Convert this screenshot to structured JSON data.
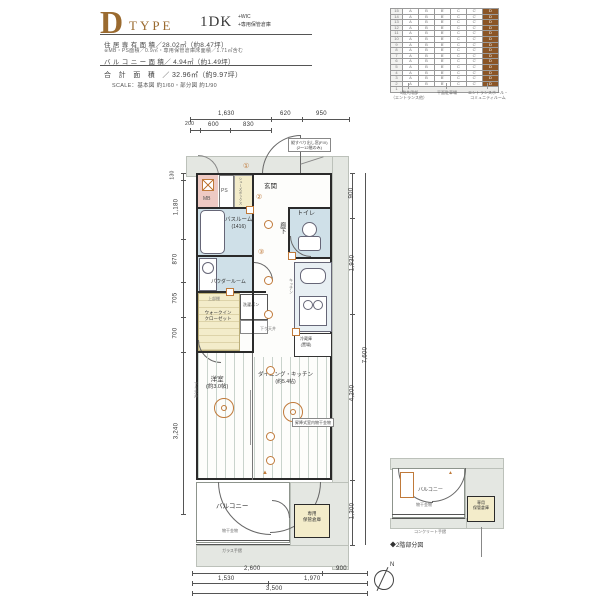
{
  "header": {
    "letter": "D",
    "type_word": "TYPE",
    "plan": "1DK",
    "plan_plus": [
      "+WIC",
      "+専用保管倉庫"
    ],
    "spec1": "住 居 専 有 面 積／28.02㎡（約8.47坪）",
    "spec2": "※MB・PS面積／0.9㎡・専用保管倉庫床面積／1.71㎡含む",
    "spec3": "バ ル コ ニ ー 面 積／ 4.94㎡（約1.49坪）",
    "total": "合　計　面　積　／ 32.96㎡（約9.97坪）",
    "scale": "SCALE：基本図 約1/60・部分図 約1/90"
  },
  "table": {
    "floors": [
      "15",
      "14",
      "13",
      "12",
      "11",
      "10",
      "9",
      "8",
      "7",
      "6",
      "5",
      "4",
      "3",
      "2"
    ],
    "cols": [
      "A",
      "B",
      "B'",
      "C",
      "C'",
      "D"
    ],
    "highlight": "D",
    "bottom": "1",
    "captions": [
      [
        "1階共用部",
        "（エントランス他）"
      ],
      [
        "平面駐車場",
        ""
      ],
      [
        "エントランスホール・",
        "コミュニティルーム"
      ]
    ]
  },
  "plan": {
    "labels": {
      "mb": "MB",
      "ps": "PS",
      "shoes": "シューズボックス",
      "genkan": "玄関",
      "toilet": "トイレ",
      "hall": "廊下",
      "bath": "バスルーム",
      "bath_size": "(1416)",
      "powder": "パウダールーム",
      "shelf": "上部棚",
      "wic1": "ウォークイン",
      "wic2": "クローゼット",
      "washer": "洗濯パン",
      "kitchen": "キッチン",
      "fridge1": "冷蔵庫",
      "fridge2": "(置場)",
      "dk": "ダイニング・キッチン",
      "dk_size": "(約5.4帖)",
      "bed": "洋室",
      "bed_size": "(約3.0帖)",
      "balcony": "バルコニー",
      "monohoshi": "物干金物",
      "glass": "ガラス手摺",
      "storage1": "専用",
      "storage2": "保管倉庫",
      "down": "下り天井",
      "laundry_note": "昇降式室内物干金物",
      "win_note1": "縦すべり出し窓(FIX)",
      "win_note2": "(2〜12階のみ)"
    },
    "marks": {
      "m1": "①",
      "m2": "②",
      "m3": "③",
      "tri": "▲"
    },
    "dims": {
      "top1": [
        "1,630",
        "620",
        "950"
      ],
      "top2": [
        "200",
        "600",
        "830"
      ],
      "left": [
        "130",
        "1,180",
        "870",
        "705",
        "700",
        "3,240"
      ],
      "right": [
        "900",
        "1,930",
        "4,200",
        "1,300"
      ],
      "right_total": "7,600",
      "bottom1": [
        "2,600",
        "900"
      ],
      "bottom2": [
        "1,530",
        "1,970"
      ],
      "bottom3": "3,500"
    }
  },
  "mini": {
    "balcony": "バルコニー",
    "monohoshi": "物干金物",
    "storage1": "専用",
    "storage2": "保管倉庫",
    "rail": "コンクリート手摺",
    "caption": "◆2階部分図"
  },
  "compass": {
    "n": "N"
  },
  "colors": {
    "accent": "#9a6a2f",
    "table_highlight": "#8a5526",
    "wet": "#cfe0e8",
    "closet": "#f3ecca",
    "mb": "#eecac4",
    "surround": "#e4e7e2",
    "orange": "#c07a3a"
  }
}
